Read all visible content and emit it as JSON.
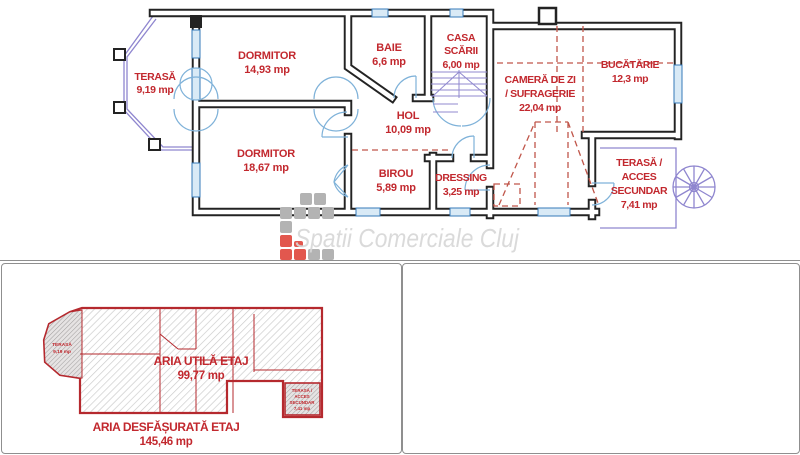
{
  "watermark": {
    "text": "Spatii Comerciale Cluj"
  },
  "colors": {
    "wall": "#232323",
    "label_red": "#c2282e",
    "window_blue": "#3579b8",
    "door_blue": "#7fb2d9",
    "terrace_purple": "#8f86cf",
    "dashed_red": "#c0564a",
    "outline_red": "#b5292e",
    "watermark_gray": "#d7d7d7",
    "logo_red": "#e2574e",
    "logo_gray": "#b3b3b3"
  },
  "floor_plan": {
    "terasa": {
      "name": "TERASĂ",
      "area": "9,19 mp"
    },
    "dormitor_1": {
      "name": "DORMITOR",
      "area": "14,93 mp"
    },
    "baie": {
      "name": "BAIE",
      "area": "6,6 mp"
    },
    "casa_scarii": {
      "line1": "CASA",
      "line2": "SCĂRII",
      "area": "6,00 mp"
    },
    "camera_de_zi": {
      "line1": "CAMERĂ DE ZI",
      "line2": "/ SUFRAGERIE",
      "area": "22,04 mp"
    },
    "bucatarie": {
      "name": "BUCĂTĂRIE",
      "area": "12,3 mp"
    },
    "dormitor_2": {
      "name": "DORMITOR",
      "area": "18,67 mp"
    },
    "hol": {
      "name": "HOL",
      "area": "10,09 mp"
    },
    "birou": {
      "name": "BIROU",
      "area": "5,89 mp"
    },
    "dressing": {
      "name": "DRESSING",
      "area": "3,25 mp"
    },
    "terasa_acces": {
      "line1": "TERASĂ /",
      "line2": "ACCES",
      "line3": "SECUNDAR",
      "area": "7,41 mp"
    }
  },
  "summary_plan": {
    "terasa": {
      "name": "TERASĂ",
      "area": "9,19 mp"
    },
    "aria_utila": {
      "label": "ARIA UTILĂ ETAJ",
      "value": "99,77 mp"
    },
    "terasa_acces": {
      "line1": "TERASĂ /",
      "line2": "ACCES",
      "line3": "SECUNDAR",
      "area": "7,41 mp"
    },
    "aria_desfasurata": {
      "label": "ARIA DESFĂȘURATĂ ETAJ",
      "value": "145,46 mp"
    }
  }
}
